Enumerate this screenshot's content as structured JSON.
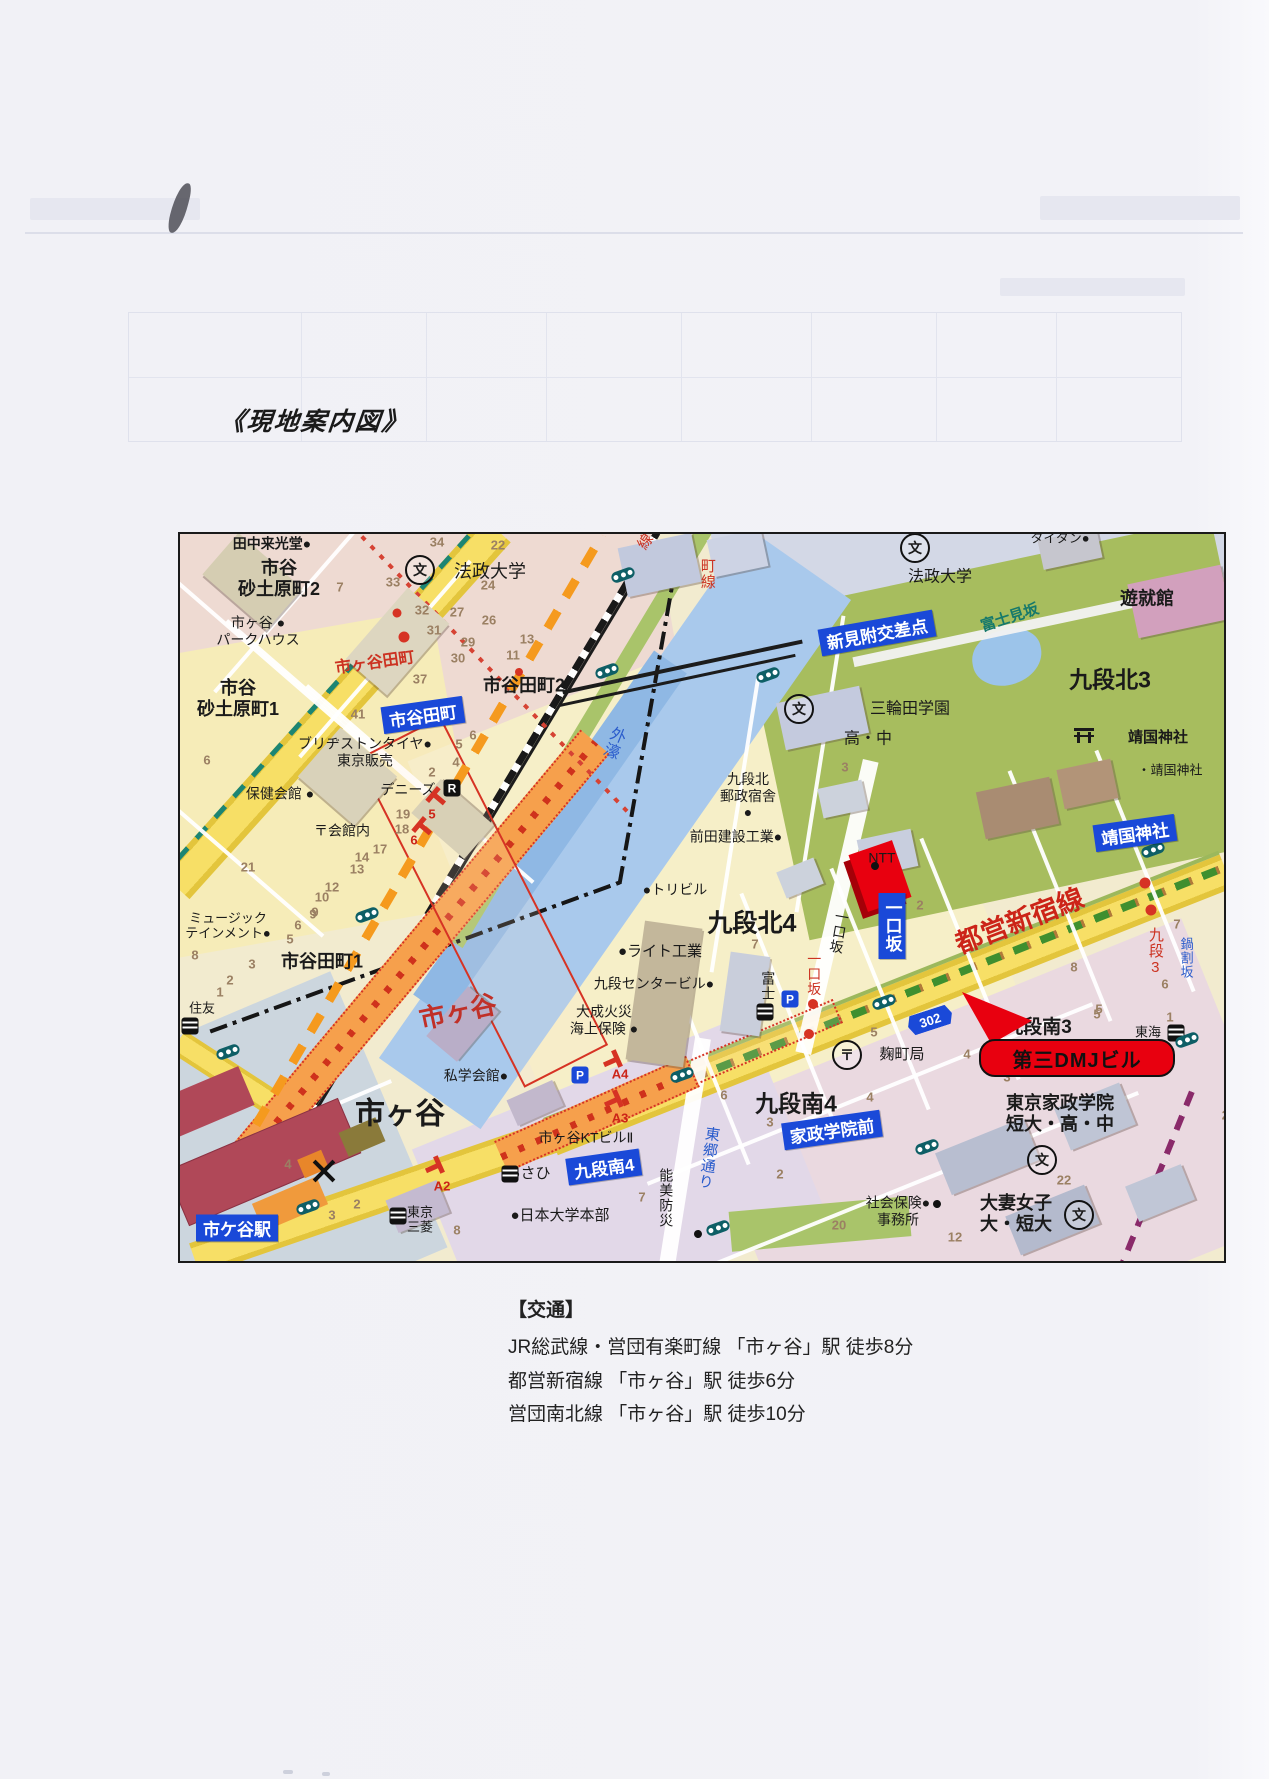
{
  "page": {
    "title": "《現地案内図》"
  },
  "access": {
    "heading": "【交通】",
    "lines": [
      "JR総武線・営団有楽町線 「市ヶ谷」駅  徒歩8分",
      "都営新宿線 「市ヶ谷」駅  徒歩6分",
      "営団南北線 「市ヶ谷」駅  徒歩10分"
    ]
  },
  "colors": {
    "badge_blue": "#1a49d8",
    "road_yellow": "#f5d84a",
    "water_blue": "#a9c9ec",
    "park_green": "#a7bd5e",
    "landmark_red": "#e8000f",
    "metro_orange": "#f59a1e",
    "rail_black": "#1c1c1c",
    "label_red": "#cc2418",
    "slope_blue": "#2a5ccc",
    "station_maroon": "#b04858"
  },
  "map": {
    "landmark_callout": "第三DMJビル",
    "route_shield": "302",
    "badges": [
      {
        "t": "市谷田町",
        "x": 243,
        "y": 181,
        "r": -8
      },
      {
        "t": "新見附交差点",
        "x": 697,
        "y": 99,
        "r": -10
      },
      {
        "t": "靖国神社",
        "x": 955,
        "y": 299,
        "r": -8
      },
      {
        "t": "一口坂",
        "x": 712,
        "y": 392,
        "v": 1
      },
      {
        "t": "九段南4",
        "x": 424,
        "y": 633,
        "r": -8
      },
      {
        "t": "家政学院前",
        "x": 652,
        "y": 596,
        "r": -8
      },
      {
        "t": "市ケ谷駅",
        "x": 57,
        "y": 694,
        "r": 0
      }
    ],
    "labels": [
      {
        "t": "田中来光堂●",
        "x": 92,
        "y": 10,
        "s": 14,
        "b": 1
      },
      {
        "t": "市谷\n砂土原町2",
        "x": 99,
        "y": 45,
        "s": 18,
        "b": 1
      },
      {
        "t": "法政大学",
        "x": 310,
        "y": 38,
        "s": 18
      },
      {
        "t": "市ヶ谷 ●\nパークハウス",
        "x": 78,
        "y": 97,
        "s": 14
      },
      {
        "t": "市ヶ谷田町",
        "x": 195,
        "y": 130,
        "s": 16,
        "c": "#cc3322",
        "b": 1,
        "r": -8
      },
      {
        "t": "市谷\n砂土原町1",
        "x": 58,
        "y": 165,
        "s": 18,
        "b": 1
      },
      {
        "t": "市谷田町2",
        "x": 344,
        "y": 152,
        "s": 18,
        "b": 1
      },
      {
        "t": "ブリヂストンタイヤ●\n東京販売",
        "x": 185,
        "y": 218,
        "s": 14
      },
      {
        "t": "保健会館 ●",
        "x": 100,
        "y": 260,
        "s": 14
      },
      {
        "t": "デニーズ",
        "x": 228,
        "y": 256,
        "s": 14
      },
      {
        "t": "〒会館内",
        "x": 162,
        "y": 297,
        "s": 14
      },
      {
        "t": "ミュージック\nテインメント●",
        "x": 48,
        "y": 392,
        "s": 13
      },
      {
        "t": "市谷田町1",
        "x": 142,
        "y": 428,
        "s": 18,
        "b": 1
      },
      {
        "t": "住友",
        "x": 22,
        "y": 474,
        "s": 13
      },
      {
        "t": "市ヶ谷",
        "x": 278,
        "y": 478,
        "s": 26,
        "c": "#c03028",
        "b": 1,
        "r": -12
      },
      {
        "t": "私学会館●",
        "x": 296,
        "y": 542,
        "s": 14
      },
      {
        "t": "市ヶ谷",
        "x": 220,
        "y": 580,
        "s": 30,
        "b": 1
      },
      {
        "t": "外濠",
        "x": 432,
        "y": 208,
        "s": 16,
        "c": "#2a5ccc",
        "v": 1,
        "r": 22
      },
      {
        "t": "町線",
        "x": 527,
        "y": 40,
        "s": 15,
        "c": "#cc3322",
        "v": 1
      },
      {
        "t": "線",
        "x": 466,
        "y": 8,
        "s": 15,
        "c": "#cc3322",
        "r": -55
      },
      {
        "t": "三輪田学園",
        "x": 730,
        "y": 176,
        "s": 16
      },
      {
        "t": "高・中",
        "x": 688,
        "y": 206,
        "s": 16
      },
      {
        "t": "富士見坂",
        "x": 830,
        "y": 84,
        "s": 15,
        "c": "#16796b",
        "b": 1,
        "r": -18
      },
      {
        "t": "タイタン●",
        "x": 880,
        "y": 4,
        "s": 13
      },
      {
        "t": "法政大学",
        "x": 760,
        "y": 44,
        "s": 16
      },
      {
        "t": "遊就館",
        "x": 967,
        "y": 65,
        "s": 18,
        "b": 1
      },
      {
        "t": "九段北3",
        "x": 930,
        "y": 146,
        "s": 23,
        "b": 1
      },
      {
        "t": "靖国神社",
        "x": 978,
        "y": 204,
        "s": 15,
        "b": 1
      },
      {
        "t": "・靖国神社",
        "x": 990,
        "y": 236,
        "s": 13
      },
      {
        "t": "九段北\n郵政宿舎\n●",
        "x": 568,
        "y": 262,
        "s": 14
      },
      {
        "t": "前田建設工業●",
        "x": 556,
        "y": 303,
        "s": 14
      },
      {
        "t": "NTT",
        "x": 702,
        "y": 324,
        "s": 14
      },
      {
        "t": "●トリビル",
        "x": 495,
        "y": 356,
        "s": 14
      },
      {
        "t": "九段北4",
        "x": 572,
        "y": 390,
        "s": 25,
        "b": 1
      },
      {
        "t": "●ライト工業",
        "x": 480,
        "y": 418,
        "s": 15
      },
      {
        "t": "九段センタービル●",
        "x": 474,
        "y": 450,
        "s": 14
      },
      {
        "t": "大成火災\n海上保険 ●",
        "x": 424,
        "y": 486,
        "s": 14
      },
      {
        "t": "富士",
        "x": 588,
        "y": 452,
        "s": 14,
        "v": 1
      },
      {
        "t": "一口坂",
        "x": 659,
        "y": 398,
        "s": 14,
        "v": 1,
        "r": 10
      },
      {
        "t": "一口坂",
        "x": 634,
        "y": 440,
        "s": 14,
        "c": "#cc3322",
        "v": 1
      },
      {
        "t": "都営新宿線",
        "x": 840,
        "y": 388,
        "s": 27,
        "c": "#cc2418",
        "b": 1,
        "r": -21
      },
      {
        "t": "麹町局",
        "x": 722,
        "y": 521,
        "s": 15
      },
      {
        "t": "九段3",
        "x": 975,
        "y": 418,
        "s": 15,
        "c": "#cc3322",
        "v": 1
      },
      {
        "t": "鍋割坂",
        "x": 1006,
        "y": 424,
        "s": 13,
        "c": "#2a5ccc",
        "v": 1
      },
      {
        "t": "九段南3",
        "x": 858,
        "y": 494,
        "s": 19,
        "b": 1
      },
      {
        "t": "東海",
        "x": 968,
        "y": 498,
        "s": 13
      },
      {
        "t": "東京家政学院\n短大・高・中",
        "x": 880,
        "y": 580,
        "s": 18,
        "b": 1
      },
      {
        "t": "九段南4",
        "x": 616,
        "y": 570,
        "s": 23,
        "b": 1
      },
      {
        "t": "あさひ",
        "x": 348,
        "y": 640,
        "s": 15
      },
      {
        "t": "市ヶ谷KTビルⅡ",
        "x": 406,
        "y": 604,
        "s": 14
      },
      {
        "t": "A4",
        "x": 440,
        "y": 540,
        "s": 13,
        "c": "#cc2418",
        "b": 1
      },
      {
        "t": "A3",
        "x": 440,
        "y": 584,
        "s": 13,
        "c": "#cc2418",
        "b": 1
      },
      {
        "t": "A2",
        "x": 262,
        "y": 652,
        "s": 13,
        "c": "#cc2418",
        "b": 1
      },
      {
        "t": "能美防災",
        "x": 486,
        "y": 664,
        "s": 14,
        "v": 1
      },
      {
        "t": "●日本大学本部",
        "x": 380,
        "y": 682,
        "s": 15
      },
      {
        "t": "東郷通り",
        "x": 528,
        "y": 624,
        "s": 15,
        "c": "#2a5ccc",
        "v": 1,
        "r": 8
      },
      {
        "t": "社会保険●\n事務所",
        "x": 718,
        "y": 677,
        "s": 14
      },
      {
        "t": "大妻女子\n大・短大",
        "x": 836,
        "y": 680,
        "s": 18,
        "b": 1
      },
      {
        "t": "東京\n三菱",
        "x": 240,
        "y": 686,
        "s": 13
      }
    ],
    "numbers": [
      {
        "t": "34",
        "x": 257,
        "y": 8
      },
      {
        "t": "22",
        "x": 318,
        "y": 11
      },
      {
        "t": "33",
        "x": 213,
        "y": 48
      },
      {
        "t": "7",
        "x": 160,
        "y": 53
      },
      {
        "t": "32",
        "x": 242,
        "y": 76
      },
      {
        "t": "27",
        "x": 277,
        "y": 78
      },
      {
        "t": "24",
        "x": 308,
        "y": 51
      },
      {
        "t": "31",
        "x": 254,
        "y": 96
      },
      {
        "t": "26",
        "x": 309,
        "y": 86
      },
      {
        "t": "29",
        "x": 288,
        "y": 108
      },
      {
        "t": "13",
        "x": 347,
        "y": 105
      },
      {
        "t": "30",
        "x": 278,
        "y": 124
      },
      {
        "t": "11",
        "x": 333,
        "y": 121
      },
      {
        "t": "37",
        "x": 240,
        "y": 145
      },
      {
        "t": "41",
        "x": 178,
        "y": 180
      },
      {
        "t": "5",
        "x": 279,
        "y": 210
      },
      {
        "t": "6",
        "x": 293,
        "y": 201
      },
      {
        "t": "4",
        "x": 276,
        "y": 228
      },
      {
        "t": "2",
        "x": 252,
        "y": 238
      },
      {
        "t": "19",
        "x": 223,
        "y": 280
      },
      {
        "t": "18",
        "x": 222,
        "y": 295
      },
      {
        "t": "17",
        "x": 200,
        "y": 315
      },
      {
        "t": "14",
        "x": 182,
        "y": 323
      },
      {
        "t": "13",
        "x": 177,
        "y": 335
      },
      {
        "t": "12",
        "x": 152,
        "y": 353
      },
      {
        "t": "10",
        "x": 142,
        "y": 363
      },
      {
        "t": "9",
        "x": 135,
        "y": 378
      },
      {
        "t": "21",
        "x": 68,
        "y": 333
      },
      {
        "t": "6",
        "x": 27,
        "y": 226
      },
      {
        "t": "3",
        "x": 665,
        "y": 233
      },
      {
        "t": "7",
        "x": 575,
        "y": 410
      },
      {
        "t": "2",
        "x": 740,
        "y": 371
      },
      {
        "t": "8",
        "x": 894,
        "y": 433
      },
      {
        "t": "7",
        "x": 997,
        "y": 390
      },
      {
        "t": "6",
        "x": 985,
        "y": 450
      },
      {
        "t": "5",
        "x": 919,
        "y": 475
      },
      {
        "t": "1",
        "x": 990,
        "y": 483
      },
      {
        "t": "5",
        "x": 917,
        "y": 480
      },
      {
        "t": "4",
        "x": 787,
        "y": 520
      },
      {
        "t": "3",
        "x": 827,
        "y": 543
      },
      {
        "t": "24",
        "x": 1049,
        "y": 581
      },
      {
        "t": "4",
        "x": 690,
        "y": 563
      },
      {
        "t": "22",
        "x": 884,
        "y": 646
      },
      {
        "t": "12",
        "x": 775,
        "y": 703
      },
      {
        "t": "20",
        "x": 659,
        "y": 691
      },
      {
        "t": "7",
        "x": 462,
        "y": 663
      },
      {
        "t": "6",
        "x": 544,
        "y": 561
      },
      {
        "t": "3",
        "x": 590,
        "y": 588
      },
      {
        "t": "2",
        "x": 600,
        "y": 640
      },
      {
        "t": "9",
        "x": 133,
        "y": 380
      },
      {
        "t": "6",
        "x": 118,
        "y": 391
      },
      {
        "t": "5",
        "x": 110,
        "y": 405
      },
      {
        "t": "3",
        "x": 72,
        "y": 430
      },
      {
        "t": "2",
        "x": 50,
        "y": 446
      },
      {
        "t": "1",
        "x": 40,
        "y": 458
      },
      {
        "t": "8",
        "x": 15,
        "y": 421
      },
      {
        "t": "4",
        "x": 108,
        "y": 630
      },
      {
        "t": "3",
        "x": 152,
        "y": 681
      },
      {
        "t": "2",
        "x": 177,
        "y": 670
      },
      {
        "t": "8",
        "x": 277,
        "y": 696
      },
      {
        "t": "5",
        "x": 694,
        "y": 498
      },
      {
        "t": "5",
        "x": 252,
        "y": 280,
        "c": "#cc2418"
      },
      {
        "t": "6",
        "x": 234,
        "y": 306,
        "c": "#cc2418"
      }
    ],
    "dots": [
      {
        "x": 217,
        "y": 79,
        "c": "#d63324",
        "r": 9
      },
      {
        "x": 224,
        "y": 103,
        "c": "#d63324",
        "r": 11
      },
      {
        "x": 339,
        "y": 138,
        "c": "#d63324",
        "r": 8
      },
      {
        "x": 965,
        "y": 349,
        "c": "#d63324",
        "r": 11
      },
      {
        "x": 971,
        "y": 376,
        "c": "#d63324",
        "r": 11
      },
      {
        "x": 633,
        "y": 470,
        "c": "#d63324",
        "r": 10
      },
      {
        "x": 629,
        "y": 500,
        "c": "#d63324",
        "r": 10
      },
      {
        "x": 695,
        "y": 332,
        "c": "#111",
        "r": 8
      },
      {
        "x": 518,
        "y": 700,
        "c": "#111",
        "r": 8
      },
      {
        "x": 757,
        "y": 670,
        "c": "#111",
        "r": 8
      }
    ],
    "icons": [
      {
        "k": "school",
        "x": 240,
        "y": 36
      },
      {
        "k": "school",
        "x": 735,
        "y": 14
      },
      {
        "k": "school",
        "x": 619,
        "y": 175
      },
      {
        "k": "school",
        "x": 862,
        "y": 626
      },
      {
        "k": "school",
        "x": 899,
        "y": 681
      },
      {
        "k": "post",
        "x": 667,
        "y": 521
      },
      {
        "k": "bank",
        "x": 330,
        "y": 640
      },
      {
        "k": "bank",
        "x": 218,
        "y": 682
      },
      {
        "k": "bank",
        "x": 10,
        "y": 492
      },
      {
        "k": "bank",
        "x": 585,
        "y": 478
      },
      {
        "k": "bank",
        "x": 996,
        "y": 499
      },
      {
        "k": "park",
        "x": 400,
        "y": 541
      },
      {
        "k": "park",
        "x": 610,
        "y": 465
      },
      {
        "k": "rest",
        "x": 272,
        "y": 254
      },
      {
        "k": "torii",
        "x": 904,
        "y": 203
      },
      {
        "k": "shield",
        "x": 750,
        "y": 486,
        "r": -18
      },
      {
        "k": "tl",
        "x": 427,
        "y": 137
      },
      {
        "k": "tl",
        "x": 588,
        "y": 141
      },
      {
        "k": "tl",
        "x": 443,
        "y": 41
      },
      {
        "k": "tl",
        "x": 187,
        "y": 381
      },
      {
        "k": "tl",
        "x": 48,
        "y": 518
      },
      {
        "k": "tl",
        "x": 128,
        "y": 673
      },
      {
        "k": "tl",
        "x": 502,
        "y": 541
      },
      {
        "k": "tl",
        "x": 704,
        "y": 468
      },
      {
        "k": "tl",
        "x": 538,
        "y": 694
      },
      {
        "k": "tl",
        "x": 747,
        "y": 613
      },
      {
        "k": "tl",
        "x": 973,
        "y": 316
      },
      {
        "k": "tl",
        "x": 1007,
        "y": 506
      }
    ]
  }
}
